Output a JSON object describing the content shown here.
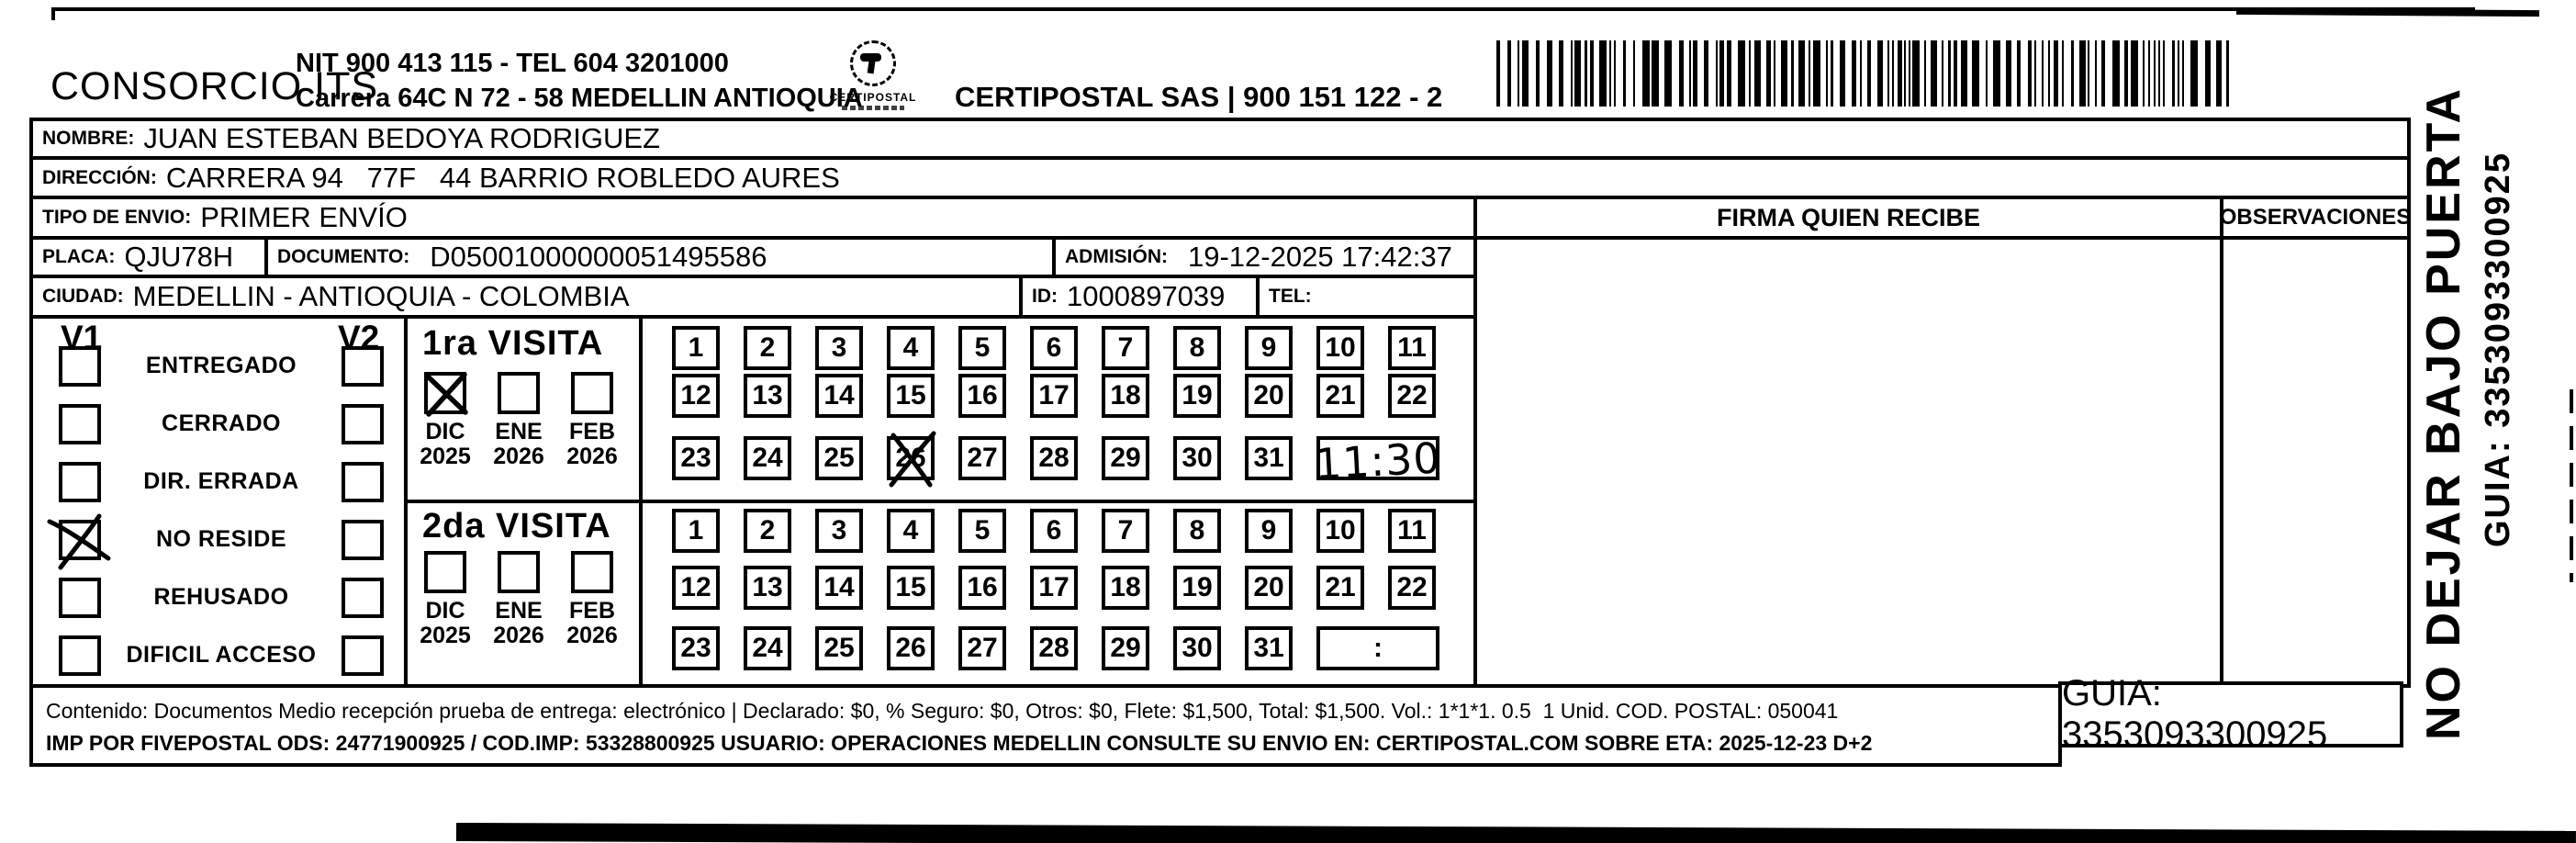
{
  "header": {
    "company": "CONSORCIO ITS",
    "sender_line1": "NIT 900 413 115 - TEL 604 3201000",
    "sender_line2": "Carrera 64C N 72 - 58 MEDELLIN ANTIOQUIA",
    "logo_text": "CERTIPOSTAL",
    "provider_line1": "CERTIPOSTAL SAS | 900 151 122 - 2",
    "provider_line2": "Carrera 80d N 18 16  Lic. 2519 De Octubre 23 De 2015"
  },
  "fields": {
    "nombre_label": "NOMBRE:",
    "nombre": "JUAN ESTEBAN BEDOYA RODRIGUEZ",
    "direccion_label": "DIRECCIÓN:",
    "direccion": "CARRERA 94   77F   44 BARRIO ROBLEDO AURES",
    "tipo_label": "TIPO DE ENVIO:",
    "tipo": "PRIMER ENVÍO",
    "placa_label": "PLACA:",
    "placa": "QJU78H",
    "documento_label": "DOCUMENTO:",
    "documento": "D05001000000051495586",
    "admision_label": "ADMISIÓN:",
    "admision": "19-12-2025 17:42:37",
    "ciudad_label": "CIUDAD:",
    "ciudad": "MEDELLIN - ANTIOQUIA - COLOMBIA",
    "id_label": "ID:",
    "id_value": "1000897039",
    "tel_label": "TEL:",
    "tel_value": ""
  },
  "signature": {
    "header": "FIRMA QUIEN RECIBE"
  },
  "observations": {
    "header": "OBSERVACIONES"
  },
  "status_panel": {
    "col1_header": "V1",
    "col2_header": "V2",
    "items": [
      {
        "label": "ENTREGADO",
        "v1_checked": false,
        "v2_checked": false
      },
      {
        "label": "CERRADO",
        "v1_checked": false,
        "v2_checked": false
      },
      {
        "label": "DIR. ERRADA",
        "v1_checked": false,
        "v2_checked": false
      },
      {
        "label": "NO RESIDE",
        "v1_checked": true,
        "v2_checked": false
      },
      {
        "label": "REHUSADO",
        "v1_checked": false,
        "v2_checked": false
      },
      {
        "label": "DIFICIL ACCESO",
        "v1_checked": false,
        "v2_checked": false
      }
    ]
  },
  "visits": [
    {
      "title": "1ra VISITA",
      "months": [
        {
          "month": "DIC",
          "year": "2025",
          "checked": true
        },
        {
          "month": "ENE",
          "year": "2026",
          "checked": false
        },
        {
          "month": "FEB",
          "year": "2026",
          "checked": false
        }
      ],
      "day_rows": [
        [
          1,
          2,
          3,
          4,
          5,
          6,
          7,
          8,
          9,
          10,
          11
        ],
        [
          12,
          13,
          14,
          15,
          16,
          17,
          18,
          19,
          20,
          21,
          22
        ],
        [
          23,
          24,
          25,
          26,
          27,
          28,
          29,
          30,
          31
        ]
      ],
      "crossed_day": 26,
      "time_value": "11:30",
      "time_handwritten": true
    },
    {
      "title": "2da VISITA",
      "months": [
        {
          "month": "DIC",
          "year": "2025",
          "checked": false
        },
        {
          "month": "ENE",
          "year": "2026",
          "checked": false
        },
        {
          "month": "FEB",
          "year": "2026",
          "checked": false
        }
      ],
      "day_rows": [
        [
          1,
          2,
          3,
          4,
          5,
          6,
          7,
          8,
          9,
          10,
          11
        ],
        [
          12,
          13,
          14,
          15,
          16,
          17,
          18,
          19,
          20,
          21,
          22
        ],
        [
          23,
          24,
          25,
          26,
          27,
          28,
          29,
          30,
          31
        ]
      ],
      "crossed_day": null,
      "time_value": ":",
      "time_handwritten": false
    }
  ],
  "footer": {
    "line1": "Contenido: Documentos Medio recepción prueba de entrega: electrónico | Declarado: $0, % Seguro: $0, Otros: $0, Flete: $1,500, Total: $1,500. Vol.: 1*1*1. 0.5  1 Unid. COD. POSTAL: 050041",
    "line2": "IMP POR FIVEPOSTAL ODS: 24771900925 / COD.IMP: 53328800925 USUARIO: OPERACIONES MEDELLIN CONSULTE SU ENVIO EN: CERTIPOSTAL.COM SOBRE ETA: 2025-12-23 D+2",
    "guia": "GUIA: 3353093300925"
  },
  "side": {
    "warning": "NO DEJAR BAJO PUERTA",
    "guia": "GUIA: 3353093300925"
  }
}
